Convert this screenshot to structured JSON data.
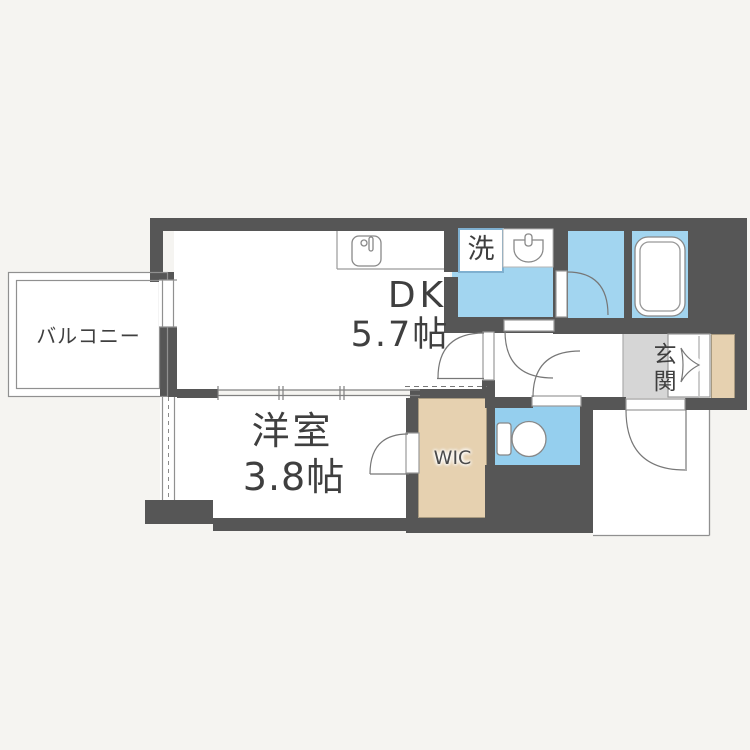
{
  "title": "1DK apartment floor plan",
  "rooms": {
    "balcony": {
      "label": "バルコニー"
    },
    "dk": {
      "label": "DK",
      "size": "5.7帖"
    },
    "western_room": {
      "label": "洋室",
      "size": "3.8帖"
    },
    "wic": {
      "label": "WIC"
    },
    "entrance": {
      "label": "玄関"
    },
    "laundry": {
      "label": "洗"
    }
  },
  "colors": {
    "wall": "#565656",
    "wet_area_blue": "#a2d5f0",
    "toilet_blue": "#95cfee",
    "wood_beige": "#e6d1b0",
    "entrance_gray": "#d6d6d6",
    "background": "#f5f4f1",
    "line_gray": "#909090",
    "text": "#3f3f3f"
  }
}
